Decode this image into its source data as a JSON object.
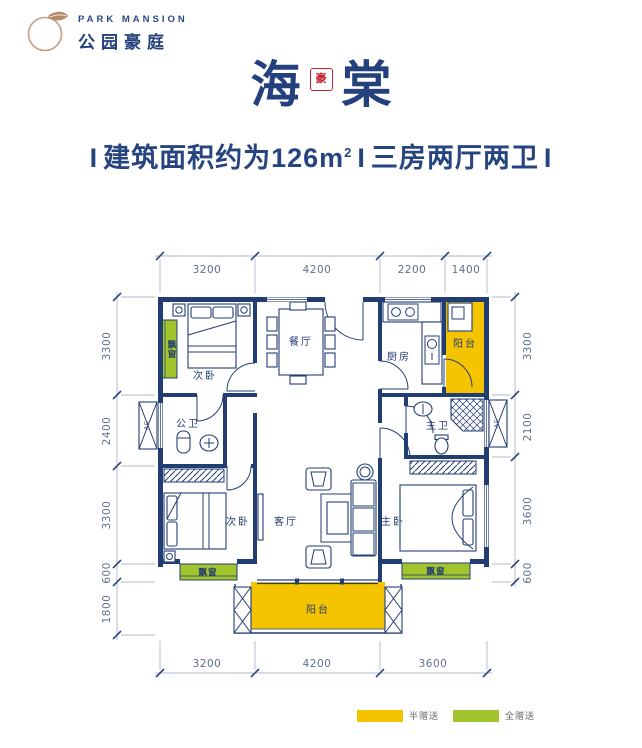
{
  "header": {
    "brand_en": "PARK MANSION",
    "brand_cn": "公园豪庭"
  },
  "title": {
    "char_left": "海",
    "char_right": "棠",
    "seal_char": "豪"
  },
  "subtitle": {
    "sep": "I",
    "area_text": "建筑面积约为126m",
    "area_sup": "2",
    "layout_text": "三房两厅两卫"
  },
  "plan": {
    "rooms": {
      "bedroom_top": "次卧",
      "dining": "餐厅",
      "kitchen": "厨房",
      "balcony_top": "阳台",
      "bath_public": "公卫",
      "bath_master": "主卫",
      "bedroom_bottom": "次卧",
      "living": "客厅",
      "bedroom_master": "主卧",
      "balcony_bottom": "阳台",
      "bay_window_tl": "飘窗",
      "bay_window_bl": "飘窗",
      "bay_window_br": "飘窗",
      "ac_label": "AC"
    },
    "dims": {
      "top": [
        "3200",
        "4200",
        "2200",
        "1400"
      ],
      "bottom": [
        "3200",
        "4200",
        "3600"
      ],
      "left": [
        "3300",
        "2400",
        "3300",
        "600",
        "1800"
      ],
      "right": [
        "3300",
        "2100",
        "3600",
        "600"
      ]
    }
  },
  "legend": {
    "items": [
      {
        "label": "半赠送",
        "color": "#F5C400"
      },
      {
        "label": "全赠送",
        "color": "#A2C52D"
      }
    ]
  },
  "colors": {
    "wall_navy": "#223D72",
    "title_navy": "#24417D",
    "accent_red": "#C42430",
    "balcony_yellow": "#F5C400",
    "bay_green": "#A2C52D",
    "logo_tan": "#C69C82",
    "dim_text": "#5F6F8F"
  }
}
